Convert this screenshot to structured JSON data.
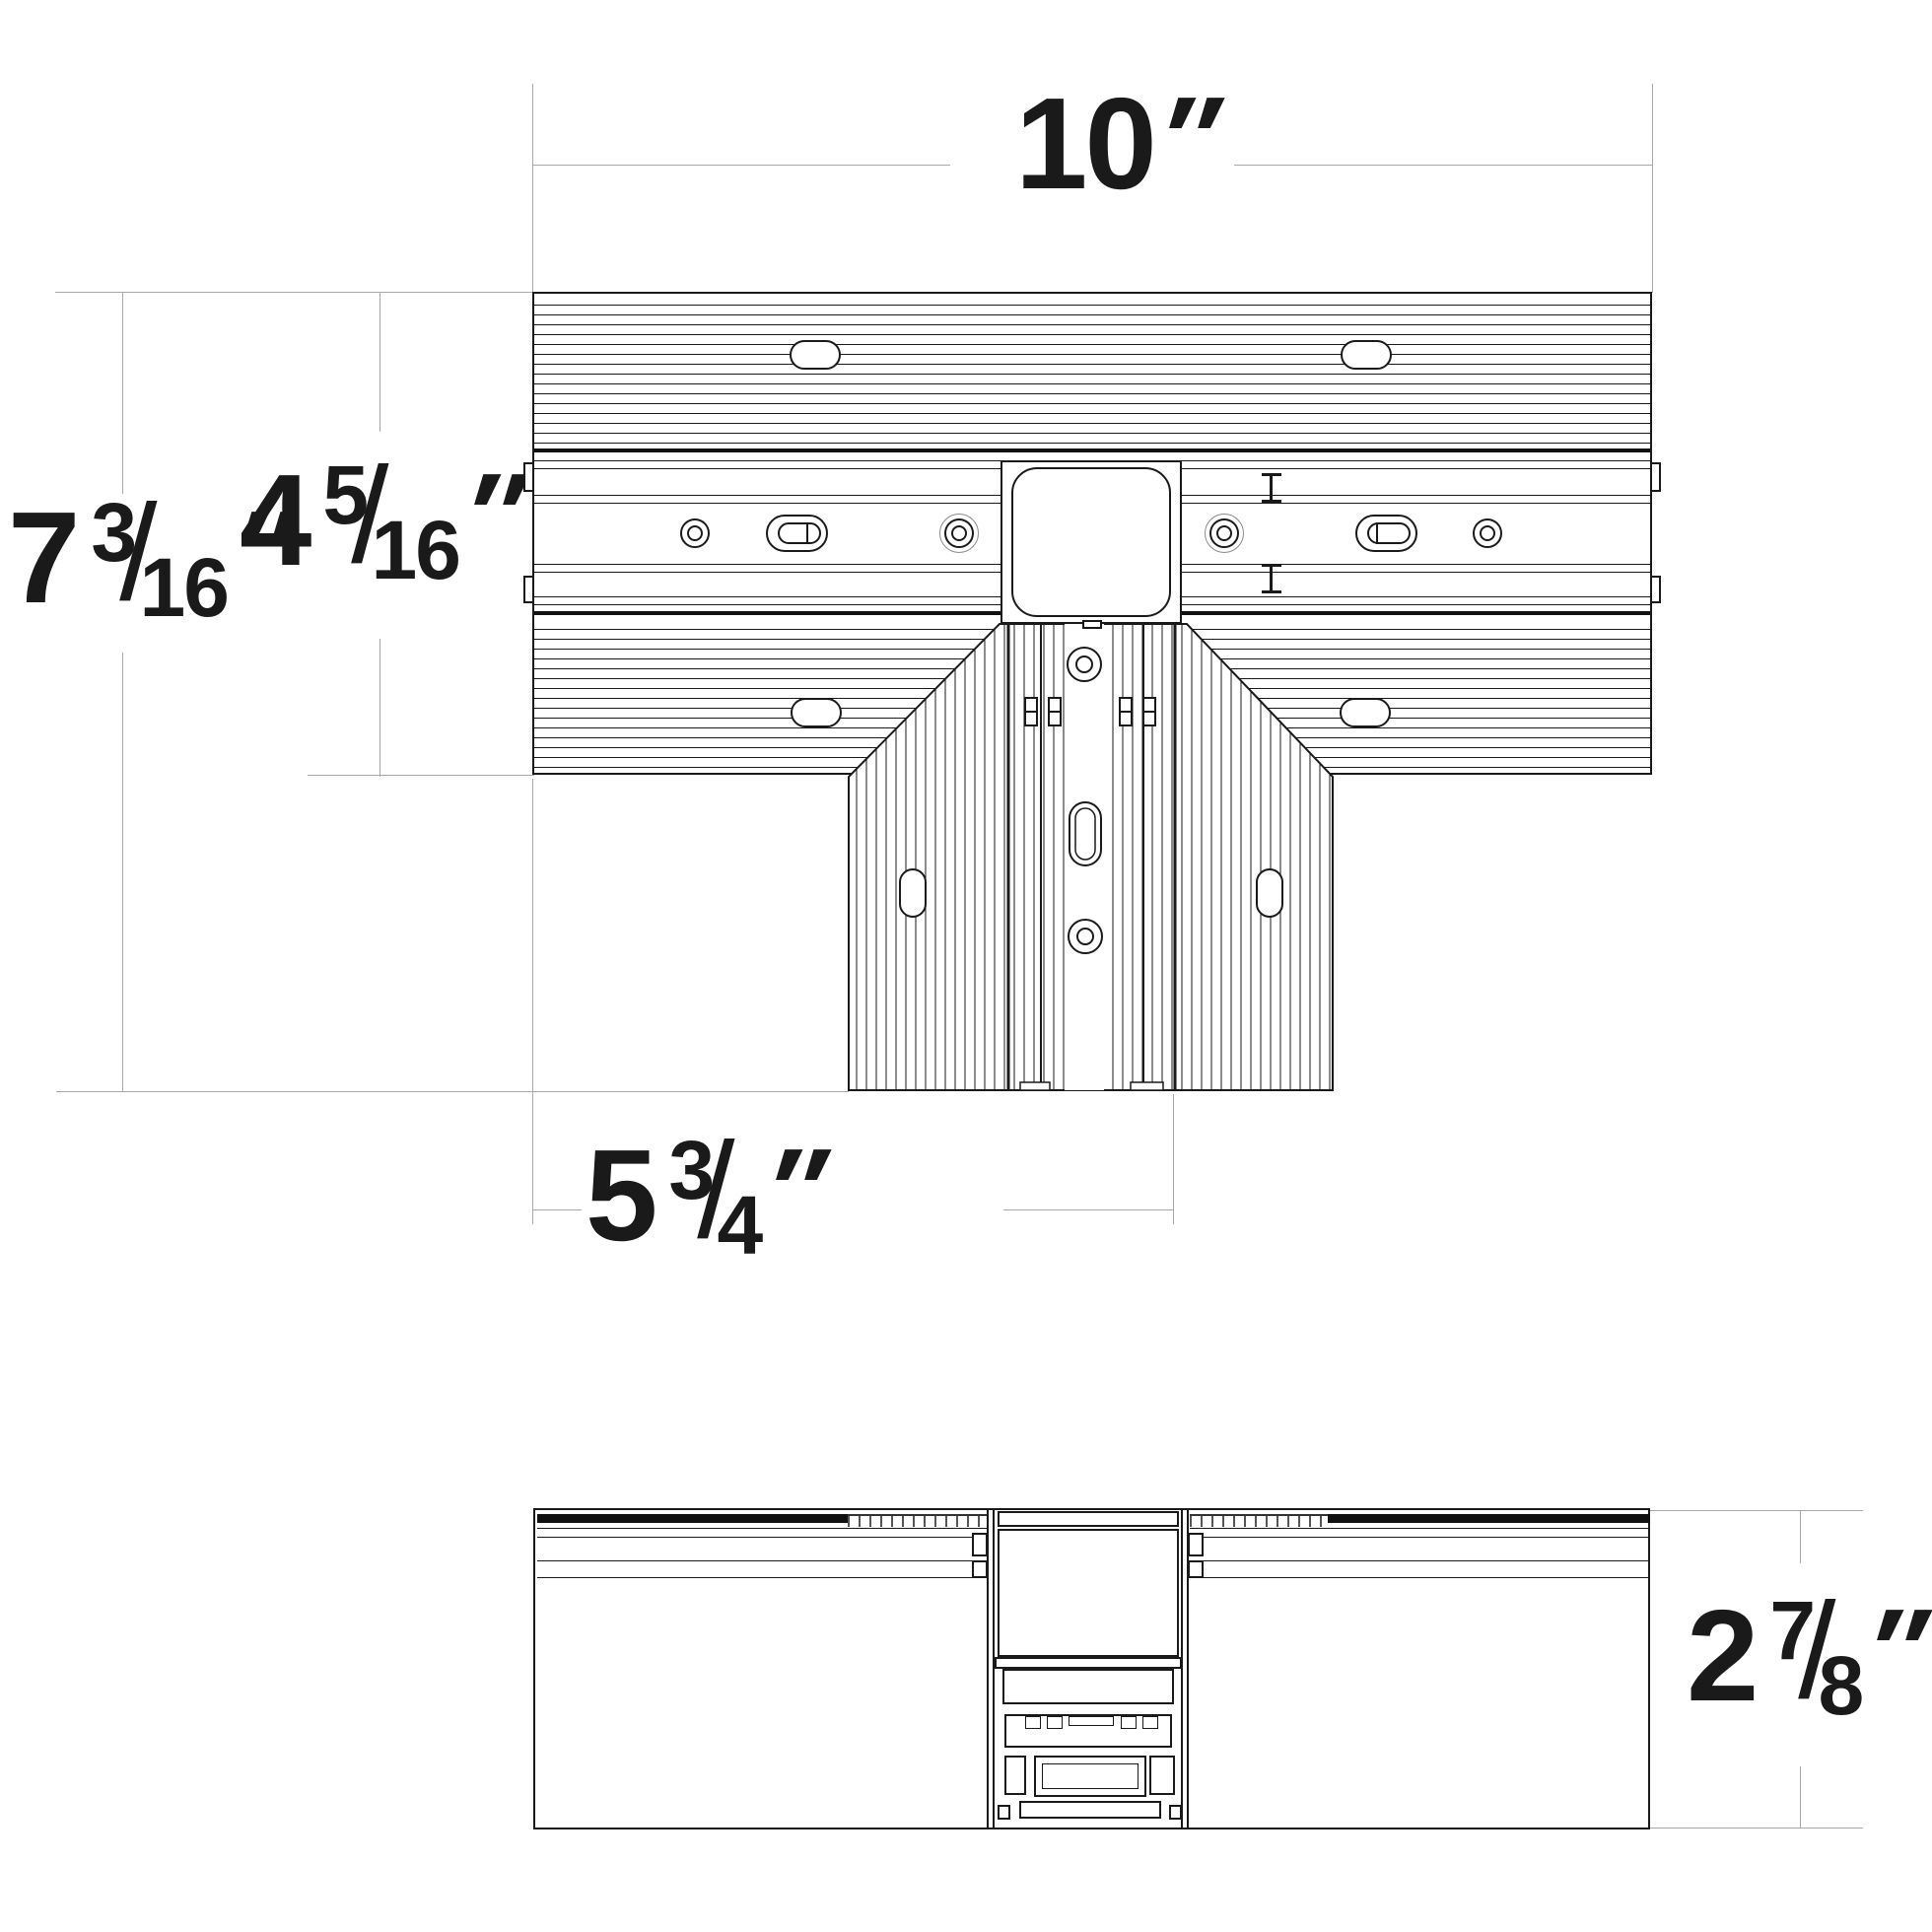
{
  "drawing": {
    "type": "technical-dimension-drawing",
    "subject": "T-shaped recessed track connector, plan view and side section view",
    "colors": {
      "object_line": "#1a1a1a",
      "dimension_line": "#a8a8a8",
      "text": "#1a1a1a",
      "background": "#ffffff"
    }
  },
  "dimensions": {
    "overall_width": {
      "whole": "10",
      "unit": "″"
    },
    "bar_depth": {
      "whole": "4",
      "num": "5",
      "slash": "/",
      "den": "16",
      "unit": "″"
    },
    "overall_depth": {
      "whole": "7",
      "num": "3",
      "slash": "/",
      "den": "16",
      "unit": "″"
    },
    "leg_extent": {
      "whole": "5",
      "num": "3",
      "slash": "/",
      "den": "4",
      "unit": "″"
    },
    "section_height": {
      "whole": "2",
      "num": "7",
      "slash": "/",
      "den": "8",
      "unit": "″"
    }
  }
}
